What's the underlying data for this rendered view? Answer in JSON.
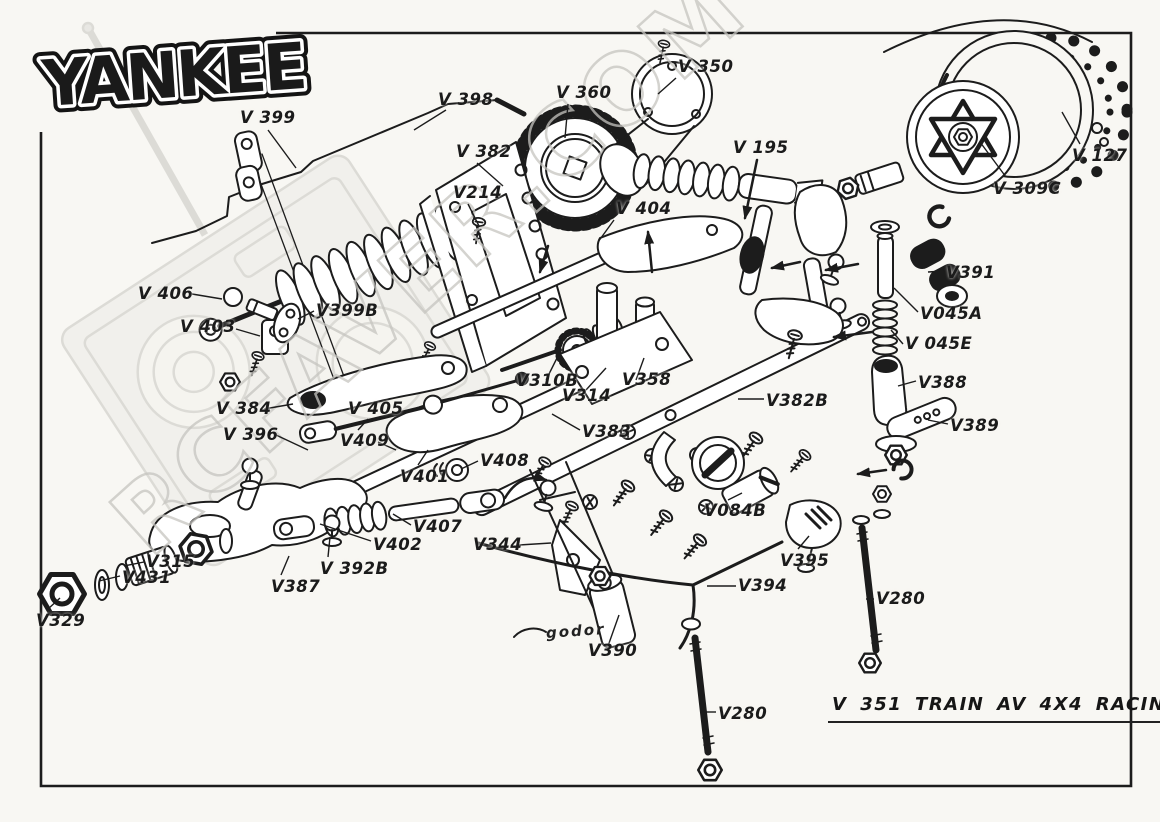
{
  "page": {
    "paper": "#f8f7f3",
    "ink": "#1c1c1c",
    "watermark_color": "#c6c5c0"
  },
  "logo": {
    "text": "YANKEE"
  },
  "watermark": {
    "text": "RCFAVER.COM"
  },
  "title_block": {
    "text": "V 351 TRAIN AV 4X4 RACING 86"
  },
  "signature": {
    "text": "godor"
  },
  "diagram": {
    "labels": [
      {
        "text": "V 399",
        "x": 240,
        "y": 108,
        "leader": [
          268,
          130,
          296,
          168
        ]
      },
      {
        "text": "V 398",
        "x": 438,
        "y": 90,
        "leader": [
          446,
          110,
          414,
          130
        ]
      },
      {
        "text": "V 360",
        "x": 556,
        "y": 83,
        "leader": [
          568,
          104,
          565,
          138
        ]
      },
      {
        "text": "V 350",
        "x": 678,
        "y": 57,
        "leader": [
          676,
          78,
          658,
          94
        ]
      },
      {
        "text": "V 195",
        "x": 733,
        "y": 138,
        "leader": null
      },
      {
        "text": "V 127",
        "x": 1072,
        "y": 146,
        "leader": [
          1080,
          144,
          1062,
          112
        ]
      },
      {
        "text": "V 309C",
        "x": 993,
        "y": 179,
        "leader": [
          1006,
          177,
          980,
          142
        ]
      },
      {
        "text": "V 382",
        "x": 456,
        "y": 142,
        "leader": [
          477,
          163,
          503,
          186
        ]
      },
      {
        "text": "V214",
        "x": 453,
        "y": 183,
        "leader": [
          468,
          204,
          479,
          226
        ]
      },
      {
        "text": "V 404",
        "x": 616,
        "y": 199,
        "leader": [
          614,
          220,
          598,
          242
        ]
      },
      {
        "text": "V 406",
        "x": 138,
        "y": 284,
        "leader": [
          192,
          294,
          222,
          299
        ]
      },
      {
        "text": "V 403",
        "x": 180,
        "y": 317,
        "leader": [
          236,
          329,
          260,
          336
        ]
      },
      {
        "text": "V399B",
        "x": 316,
        "y": 301,
        "leader": [
          314,
          311,
          298,
          319
        ]
      },
      {
        "text": "V310B",
        "x": 516,
        "y": 371,
        "leader": [
          546,
          380,
          560,
          352
        ]
      },
      {
        "text": "V314",
        "x": 562,
        "y": 386,
        "leader": [
          586,
          390,
          606,
          368
        ]
      },
      {
        "text": "V358",
        "x": 622,
        "y": 370,
        "leader": [
          636,
          380,
          644,
          358
        ]
      },
      {
        "text": "V383",
        "x": 582,
        "y": 422,
        "leader": [
          580,
          430,
          552,
          414
        ]
      },
      {
        "text": "V382B",
        "x": 766,
        "y": 391,
        "leader": [
          764,
          399,
          738,
          399
        ]
      },
      {
        "text": "V388",
        "x": 918,
        "y": 373,
        "leader": [
          916,
          381,
          898,
          386
        ]
      },
      {
        "text": "V389",
        "x": 950,
        "y": 416,
        "leader": [
          948,
          424,
          928,
          420
        ]
      },
      {
        "text": "V391",
        "x": 946,
        "y": 263,
        "leader": [
          944,
          271,
          928,
          272
        ]
      },
      {
        "text": "V045A",
        "x": 920,
        "y": 304,
        "leader": [
          918,
          312,
          894,
          288
        ]
      },
      {
        "text": "V 045E",
        "x": 905,
        "y": 334,
        "leader": [
          903,
          344,
          891,
          330
        ]
      },
      {
        "text": "V 384",
        "x": 216,
        "y": 399,
        "leader": [
          264,
          409,
          293,
          404
        ]
      },
      {
        "text": "V 396",
        "x": 223,
        "y": 425,
        "leader": [
          276,
          435,
          308,
          450
        ]
      },
      {
        "text": "V 405",
        "x": 348,
        "y": 399,
        "leader": [
          368,
          419,
          358,
          430
        ]
      },
      {
        "text": "V409",
        "x": 340,
        "y": 431,
        "leader": [
          378,
          442,
          396,
          450
        ]
      },
      {
        "text": "V401",
        "x": 400,
        "y": 467,
        "leader": [
          418,
          465,
          428,
          450
        ]
      },
      {
        "text": "V408",
        "x": 480,
        "y": 451,
        "leader": [
          478,
          461,
          461,
          469
        ]
      },
      {
        "text": "V407",
        "x": 413,
        "y": 517,
        "leader": [
          411,
          525,
          393,
          514
        ]
      },
      {
        "text": "V402",
        "x": 373,
        "y": 535,
        "leader": [
          371,
          541,
          320,
          524
        ]
      },
      {
        "text": "V344",
        "x": 473,
        "y": 535,
        "leader": [
          519,
          545,
          551,
          543
        ]
      },
      {
        "text": "V315",
        "x": 146,
        "y": 552,
        "leader": [
          144,
          562,
          124,
          566
        ]
      },
      {
        "text": "V431",
        "x": 122,
        "y": 568,
        "leader": [
          120,
          576,
          99,
          581
        ]
      },
      {
        "text": "V329",
        "x": 36,
        "y": 611,
        "leader": [
          48,
          609,
          60,
          598
        ]
      },
      {
        "text": "V387",
        "x": 271,
        "y": 577,
        "leader": [
          281,
          575,
          289,
          556
        ]
      },
      {
        "text": "V 392B",
        "x": 320,
        "y": 559,
        "leader": [
          328,
          557,
          330,
          537
        ]
      },
      {
        "text": "V084B",
        "x": 704,
        "y": 501,
        "leader": [
          728,
          500,
          742,
          493
        ]
      },
      {
        "text": "V395",
        "x": 780,
        "y": 551,
        "leader": [
          798,
          549,
          809,
          536
        ]
      },
      {
        "text": "V394",
        "x": 738,
        "y": 576,
        "leader": [
          736,
          586,
          707,
          586
        ]
      },
      {
        "text": "V390",
        "x": 588,
        "y": 641,
        "leader": [
          608,
          646,
          619,
          615
        ]
      },
      {
        "text": "V280",
        "x": 876,
        "y": 589,
        "leader": [
          874,
          599,
          866,
          599
        ]
      },
      {
        "text": "V280",
        "x": 718,
        "y": 704,
        "leader": [
          716,
          712,
          705,
          712
        ]
      }
    ]
  }
}
